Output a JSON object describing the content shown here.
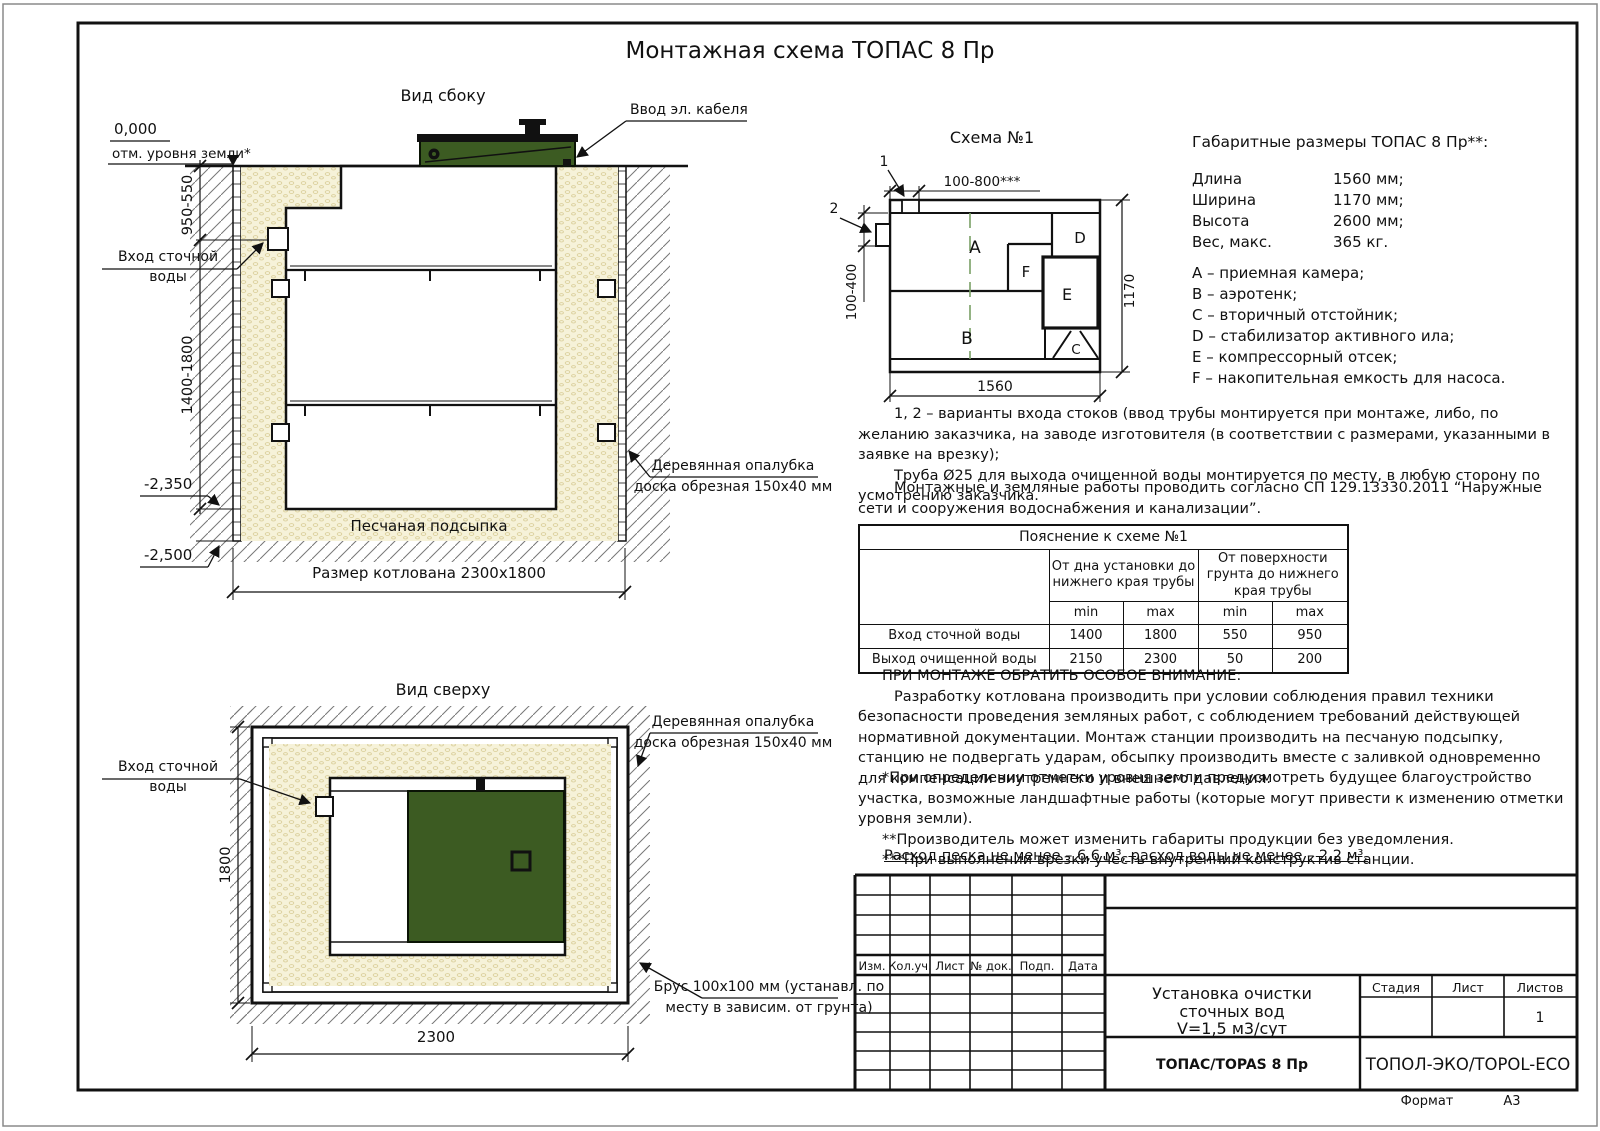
{
  "page_title": "Монтажная схема ТОПАС 8 Пр",
  "side_view": {
    "title": "Вид сбоку",
    "cable_label": "Ввод эл. кабеля",
    "zero_mark": "0,000",
    "ground_mark": "отм. уровня земли*",
    "dim_upper": "950-550",
    "dim_lower": "1400-1800",
    "inlet_label_1": "Вход сточной",
    "inlet_label_2": "воды",
    "level_minus_2350": "-2,350",
    "level_minus_2500": "-2,500",
    "sand_label": "Песчаная подсыпка",
    "pit_dim": "Размер котлована 2300х1800",
    "formwork_label_1": "Деревянная опалубка",
    "formwork_label_2": "доска обрезная 150х40 мм"
  },
  "top_view": {
    "title": "Вид сверху",
    "inlet_label_1": "Вход сточной",
    "inlet_label_2": "воды",
    "formwork_label_1": "Деревянная опалубка",
    "formwork_label_2": "доска обрезная 150х40 мм",
    "beam_label_1": "Брус 100х100 мм (устанавл. по",
    "beam_label_2": "месту в зависим. от грунта)",
    "dim_height": "1800",
    "dim_width": "2300"
  },
  "schema": {
    "title": "Схема №1",
    "marker_1": "1",
    "marker_2": "2",
    "dim_top": "100-800***",
    "dim_left": "100-400",
    "dim_width": "1560",
    "dim_height": "1170",
    "compartment_a": "A",
    "compartment_b": "B",
    "compartment_c": "C",
    "compartment_d": "D",
    "compartment_e": "E",
    "compartment_f": "F"
  },
  "specs": {
    "title": "Габаритные размеры ТОПАС 8 Пр**:",
    "rows": [
      {
        "label": "Длина",
        "value": "1560 мм;"
      },
      {
        "label": "Ширина",
        "value": "1170 мм;"
      },
      {
        "label": "Высота",
        "value": "2600 мм;"
      },
      {
        "label": "Вес, макс.",
        "value": "365 кг."
      }
    ],
    "legend": [
      "A – приемная камера;",
      "B – аэротенк;",
      "C – вторичный отстойник;",
      "D – стабилизатор активного ила;",
      "E – компрессорный отсек;",
      "F – накопительная емкость для насоса."
    ]
  },
  "notes": {
    "variants_line": "1, 2 – варианты входа  стоков (ввод трубы монтируется при монтаже, либо, по желанию заказчика, на заводе изготовителя (в соответствии с размерами, указанными в заявке на врезку);",
    "pipe_line": "Труба Ø25 для выхода очищенной воды монтируется по месту, в любую сторону по усмотрению заказчика.",
    "sp_line": "Монтажные и земляные работы проводить согласно СП 129.13330.2011 “Наружные сети и сооружения водоснабжения и канализации”.",
    "attention_title": "ПРИ МОНТАЖЕ ОБРАТИТЬ ОСОБОЕ ВНИМАНИЕ:",
    "attention_body": "Разработку котлована производить при условии соблюдения правил техники безопасности проведения земляных работ, с соблюдением требований действующей нормативной документации. Монтаж станции производить на песчаную подсыпку, станцию не подвергать ударам, обсыпку производить вместе с заливкой одновременно для компенсации внутреннего и внешнего давления.",
    "footnote_1": "*При определении отметки уровня земли предусмотреть будущее благоустройство участка, возможные ландшафтные работы (которые могут привести к изменению отметки уровня земли).",
    "footnote_2": "**Производитель может изменить габариты продукции без уведомления.",
    "footnote_3": "***При выполнении врезки учесть внутренний конструктив станции.",
    "consumption": "Расход песка не менее – 6,6 м³, расход воды не менее – 2,2 м³."
  },
  "explanation_table": {
    "title": "Пояснение к схеме №1",
    "group_1": "От дна установки до нижнего края трубы",
    "group_2": "От поверхности грунта до нижнего края трубы",
    "min_label": "min",
    "max_label": "max",
    "rows": [
      {
        "label": "Вход сточной воды",
        "v1": "1400",
        "v2": "1800",
        "v3": "550",
        "v4": "950"
      },
      {
        "label": "Выход очищенной воды",
        "v1": "2150",
        "v2": "2300",
        "v3": "50",
        "v4": "200"
      }
    ]
  },
  "title_block": {
    "rev_headers": [
      "Изм.",
      "Кол.уч.",
      "Лист",
      "№ док.",
      "Подп.",
      "Дата"
    ],
    "doc_title_1": "Установка очистки",
    "doc_title_2": "сточных вод",
    "doc_title_3": "V=1,5 м3/сут",
    "model": "ТОПАС/TOPAS 8 Пр",
    "company": "ТОПОЛ-ЭКО/TOPOL-ECO",
    "stage_label": "Стадия",
    "sheet_label": "Лист",
    "sheets_label": "Листов",
    "sheets_value": "1",
    "format_label": "Формат",
    "format_value": "А3"
  },
  "colors": {
    "tank_green": "#3c5b22",
    "sand": "#f6f2d9",
    "line": "#111111"
  }
}
